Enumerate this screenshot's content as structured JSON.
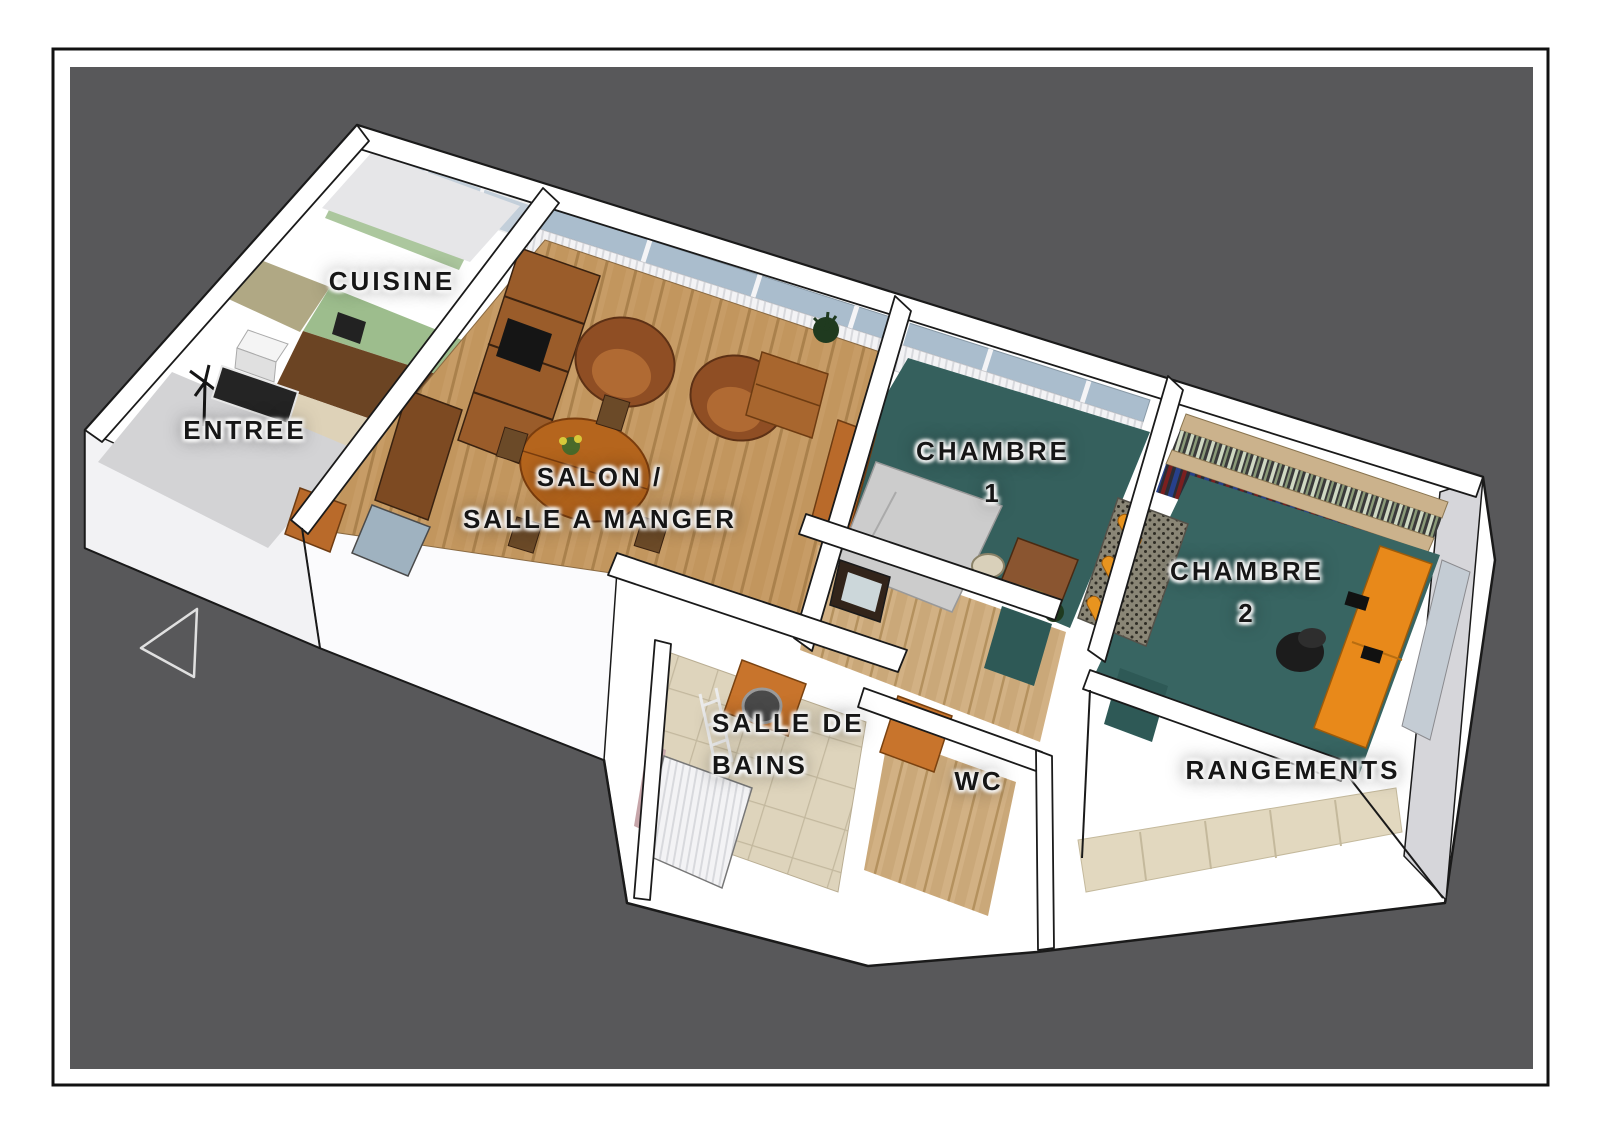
{
  "drawing": {
    "type": "3d-floor-plan-render",
    "view": "isometric aerial cutaway of a furnished apartment"
  },
  "rooms": {
    "cuisine": {
      "label": "CUISINE"
    },
    "entree": {
      "label": "ENTREE"
    },
    "salon": {
      "line1": "SALON /",
      "line2": "SALLE A MANGER"
    },
    "chambre1": {
      "line1": "CHAMBRE",
      "line2": "1"
    },
    "chambre2": {
      "line1": "CHAMBRE",
      "line2": "2"
    },
    "salle_de_bains": {
      "line1": "SALLE DE",
      "line2": "BAINS"
    },
    "wc": {
      "label": "WC"
    },
    "rangements": {
      "label": "RANGEMENTS"
    }
  },
  "icons": {
    "west_arrow": "left-pointing outline triangle"
  },
  "palette": {
    "page_background": "#ffffff",
    "frame_border": "#111111",
    "panel_background": "#58585a",
    "wall_white": "#ffffff",
    "wall_shadow": "#d6d6da",
    "floor_wood_salon": "#c79c66",
    "floor_wood_hall": "#d2b184",
    "floor_teal_chambre1": "#35605d",
    "floor_teal_chambre2": "#386562",
    "floor_tile_bath": "#ded4bc",
    "floor_gray_entree": "#d3d3d5",
    "kitchen_green": "#9dbd8d",
    "kitchen_counter": "#6b4423",
    "olive_wall": "#b0a884",
    "accent_orange_desk": "#e8891a",
    "accent_orange_cabinet": "#c8742c",
    "leather_brown": "#8f4e24",
    "table_wood": "#b5651d",
    "glass_blue": "#aabdcd",
    "label_text": "#161616",
    "label_halo": "#ffffff"
  }
}
